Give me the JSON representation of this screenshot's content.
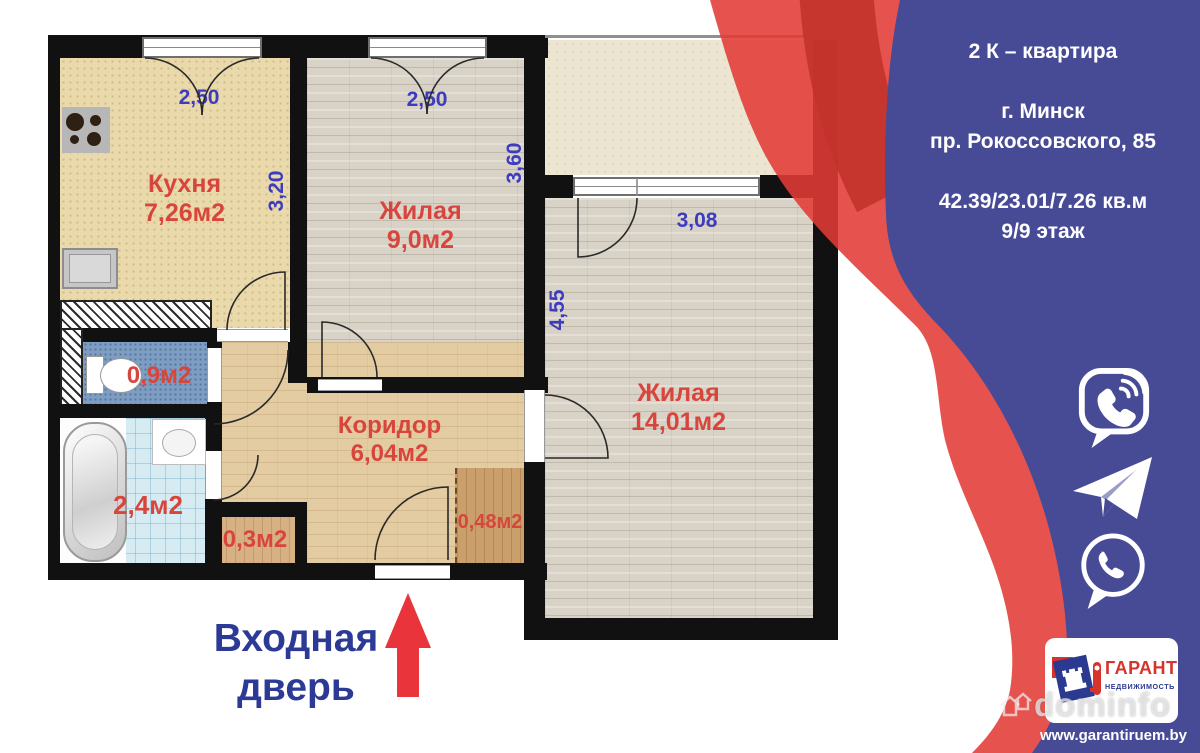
{
  "plan": {
    "rooms": {
      "kitchen": {
        "name": "Кухня",
        "area": "7,26м2",
        "width": "2,50",
        "depth": "3,20"
      },
      "living_small": {
        "name": "Жилая",
        "area": "9,0м2",
        "width": "2,50",
        "depth": "3,60"
      },
      "living_large": {
        "name": "Жилая",
        "area": "14,01м2",
        "width": "3,08",
        "depth": "4,55"
      },
      "corridor": {
        "name": "Коридор",
        "area": "6,04м2"
      },
      "wc": {
        "area": "0,9м2"
      },
      "bathroom": {
        "area": "2,4м2"
      },
      "closet_small": {
        "area": "0,3м2"
      },
      "closet_hall": {
        "area": "0,48м2"
      }
    },
    "entrance": {
      "line1": "Входная",
      "line2": "дверь"
    }
  },
  "panel": {
    "title": "2 К – квартира",
    "city": "г. Минск",
    "address": "пр. Рокоссовского, 85",
    "metrics": "42.39/23.01/7.26 кв.м",
    "floor": "9/9 этаж",
    "messengers": [
      "viber",
      "telegram",
      "whatsapp"
    ],
    "logo": {
      "title": "ГАРАНТ",
      "subtitle": "НЕДВИЖИМОСТЬ"
    },
    "website": "www.garantiruem.by",
    "watermark": "dominfo"
  },
  "colors": {
    "accent_red": "#e23b36",
    "ribbon_shadow_red": "#c3322c",
    "panel_blue": "#474b96",
    "label_red": "#d8453c",
    "dimension_blue": "#3d3cc0",
    "entrance_navy": "#2c3a96"
  }
}
